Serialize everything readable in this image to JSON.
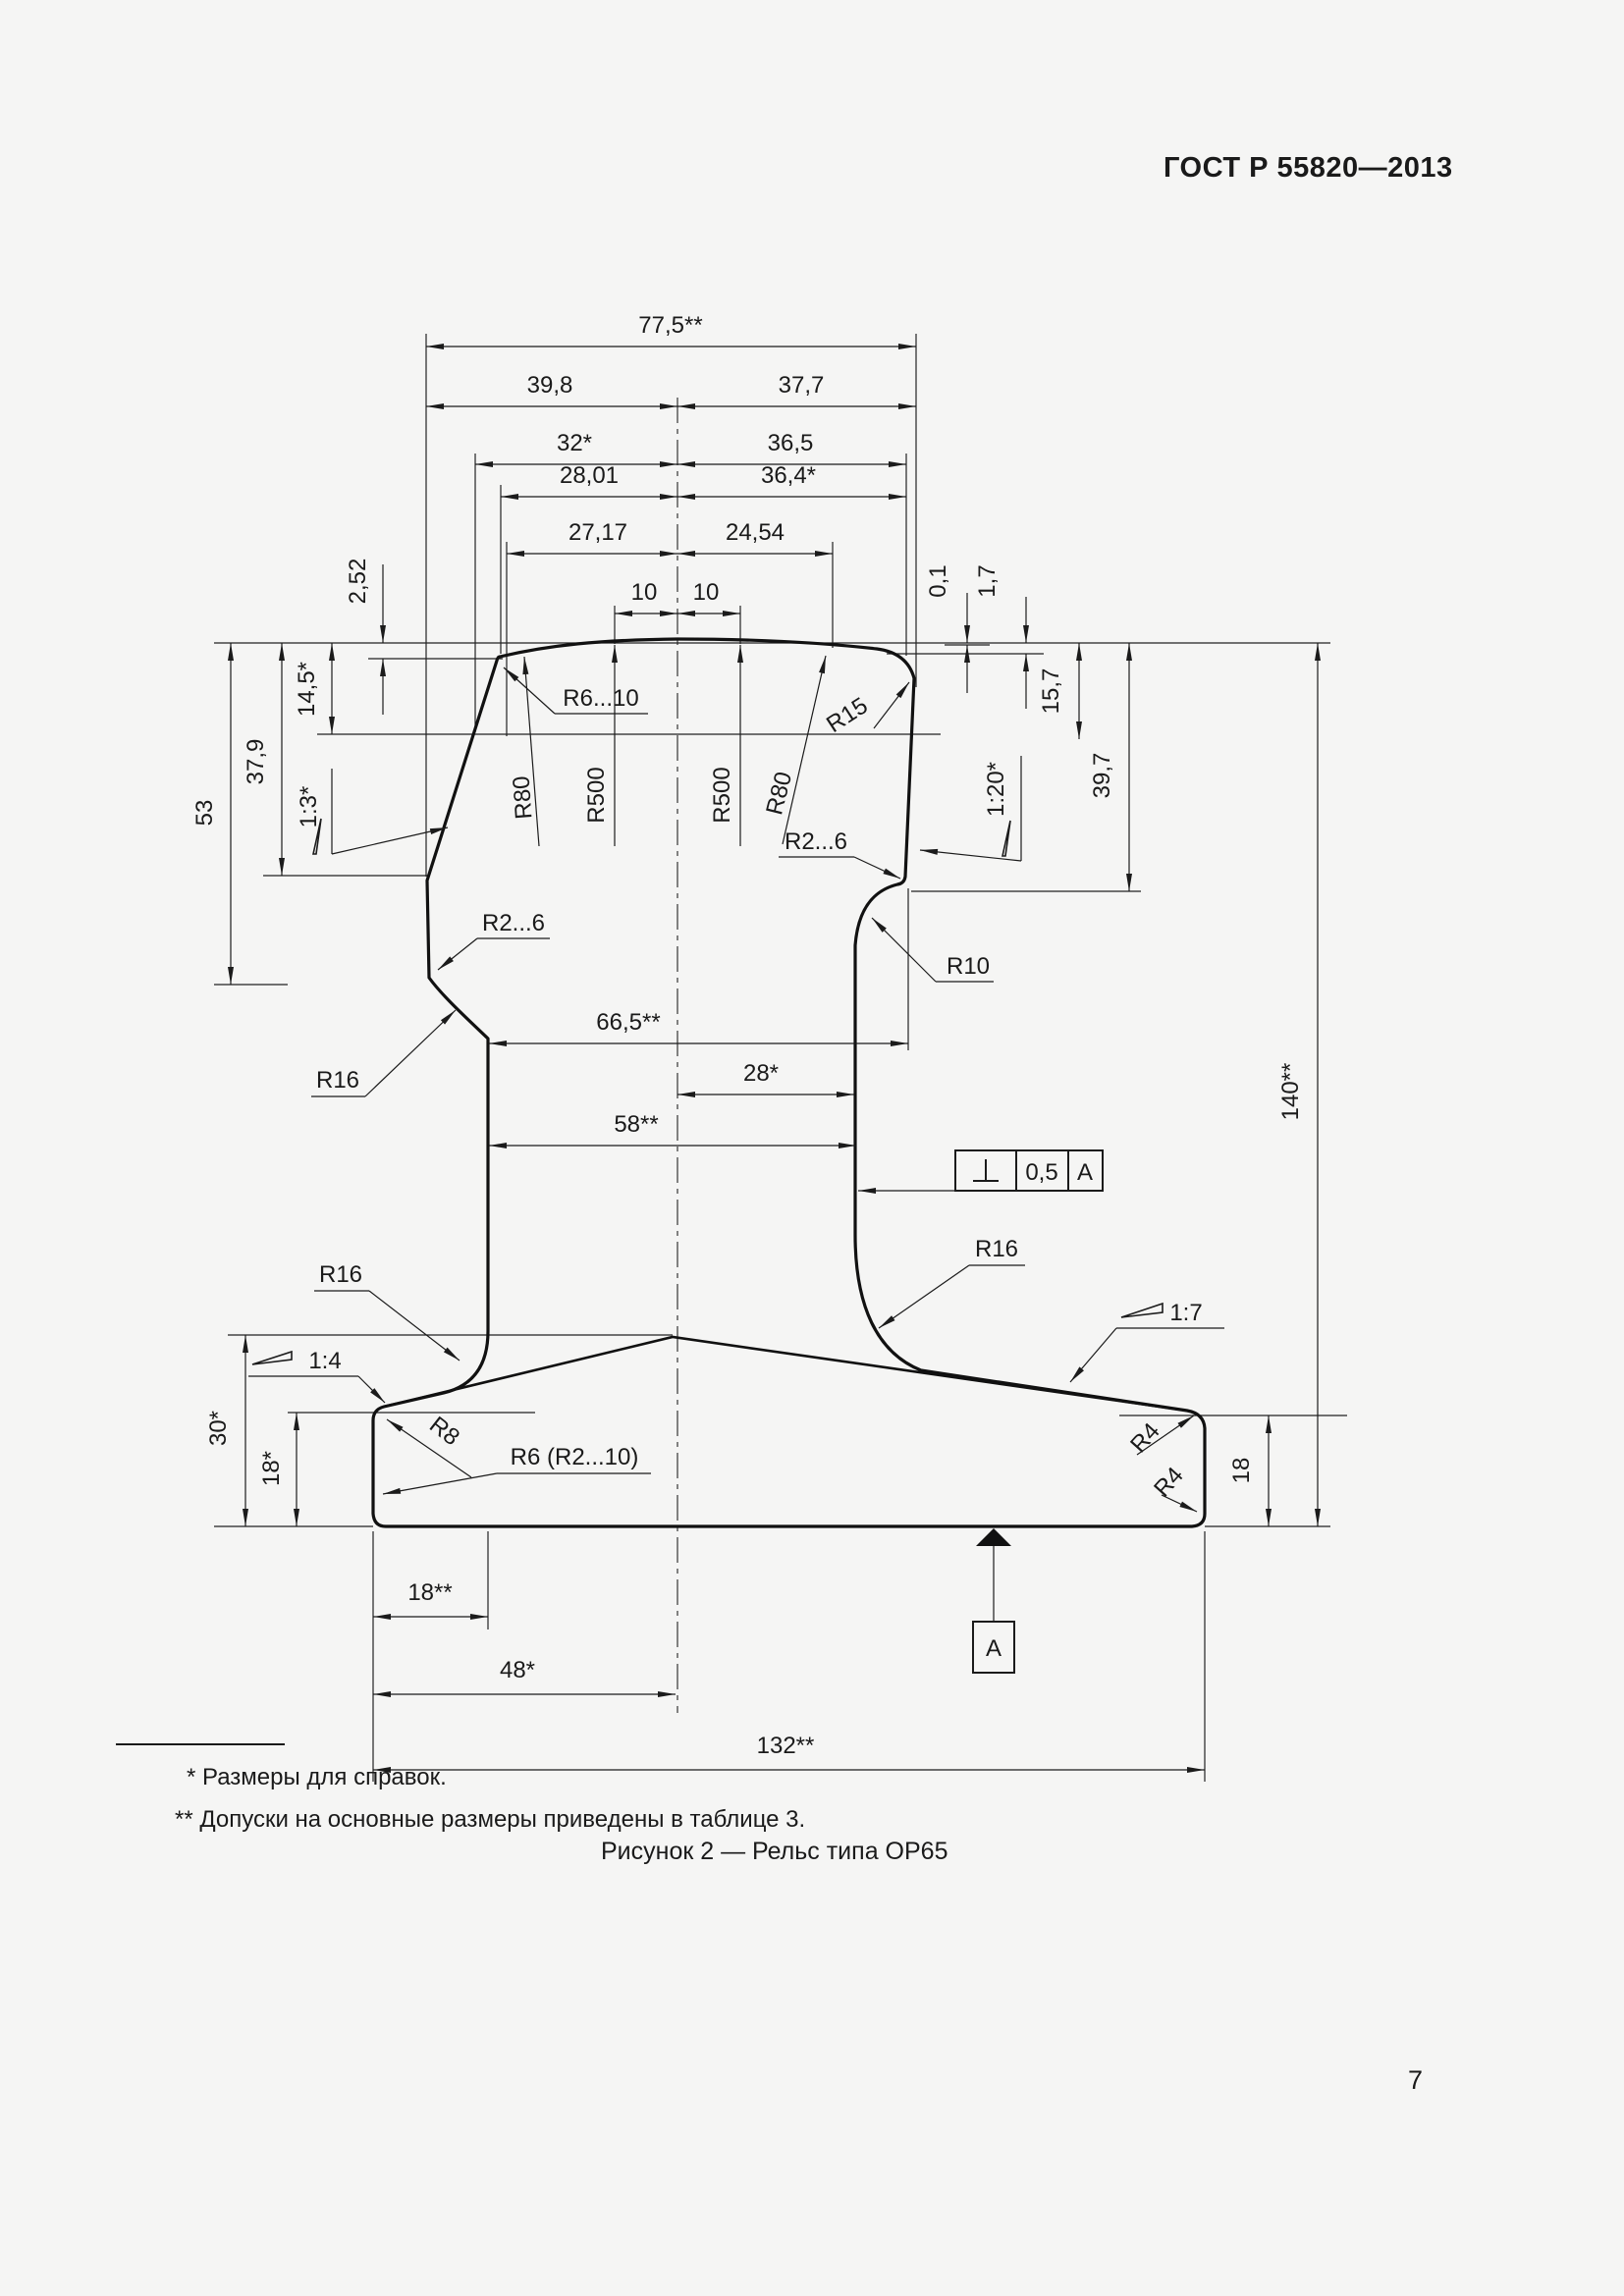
{
  "page": {
    "header": "ГОСТ Р 55820—2013",
    "footnotes": {
      "first": "* Размеры для справок.",
      "second": "** Допуски на основные размеры приведены в таблице 3."
    },
    "caption": "Рисунок 2 — Рельс типа ОР65",
    "page_number": "7"
  },
  "figure": {
    "dims": {
      "w77_5": "77,5**",
      "w39_8": "39,8",
      "w37_7": "37,7",
      "w32": "32*",
      "w36_5": "36,5",
      "w28_01": "28,01",
      "w36_4": "36,4*",
      "w27_17": "27,17",
      "w24_54": "24,54",
      "w10_left": "10",
      "w10_right": "10",
      "h2_52": "2,52",
      "h14_5": "14,5*",
      "h37_9": "37,9",
      "h53": "53",
      "h0_1": "0,1",
      "h1_7": "1,7",
      "h15_7": "15,7",
      "h39_7": "39,7",
      "h140": "140**",
      "w66_5": "66,5**",
      "w28": "28*",
      "w58": "58**",
      "h30": "30*",
      "h18_left": "18*",
      "h18_right": "18",
      "w18": "18**",
      "w48": "48*",
      "w132": "132**"
    },
    "radii": {
      "r6_10": "R6...10",
      "r80_left": "R80",
      "r500_left": "R500",
      "r500_right": "R500",
      "r80_right": "R80",
      "r15": "R15",
      "r2_6_right": "R2...6",
      "r2_6_left": "R2...6",
      "r10": "R10",
      "r16_upper_left": "R16",
      "r16_lower_left": "R16",
      "r16_lower_right": "R16",
      "r8": "R8",
      "r6_r2_10": "R6 (R2...10)",
      "r4_top": "R4",
      "r4_bottom": "R4"
    },
    "slopes": {
      "left_head": "1:3*",
      "right_head": "1:20*",
      "foot_left": "1:4",
      "foot_right": "1:7"
    },
    "tolerance": {
      "value": "0,5",
      "datum": "A"
    },
    "datum_flag": "A"
  }
}
